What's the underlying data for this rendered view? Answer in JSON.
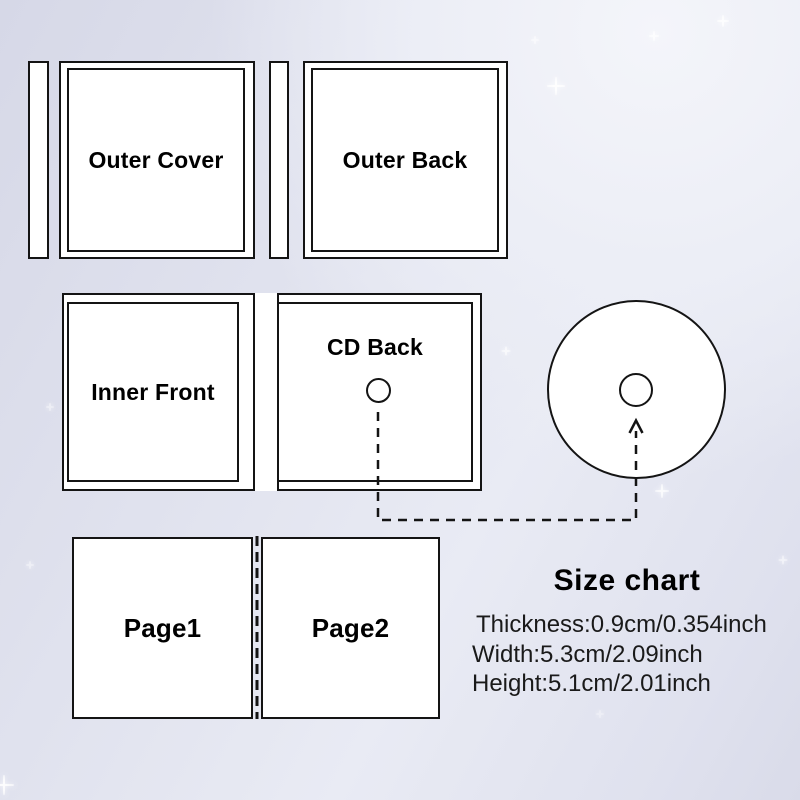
{
  "panels": {
    "outer_cover": "Outer Cover",
    "outer_back": "Outer Back",
    "inner_front": "Inner Front",
    "cd_back": "CD Back",
    "page1": "Page1",
    "page2": "Page2"
  },
  "size_chart": {
    "title": "Size chart",
    "thickness": "Thickness:0.9cm/0.354inch",
    "width": "Width:5.3cm/2.09inch",
    "height": "Height:5.1cm/2.01inch"
  },
  "colors": {
    "line": "#141414",
    "panel_fill": "#ffffff",
    "bg_light": "#f4f5fa",
    "bg_dark": "#d6d8e7"
  }
}
